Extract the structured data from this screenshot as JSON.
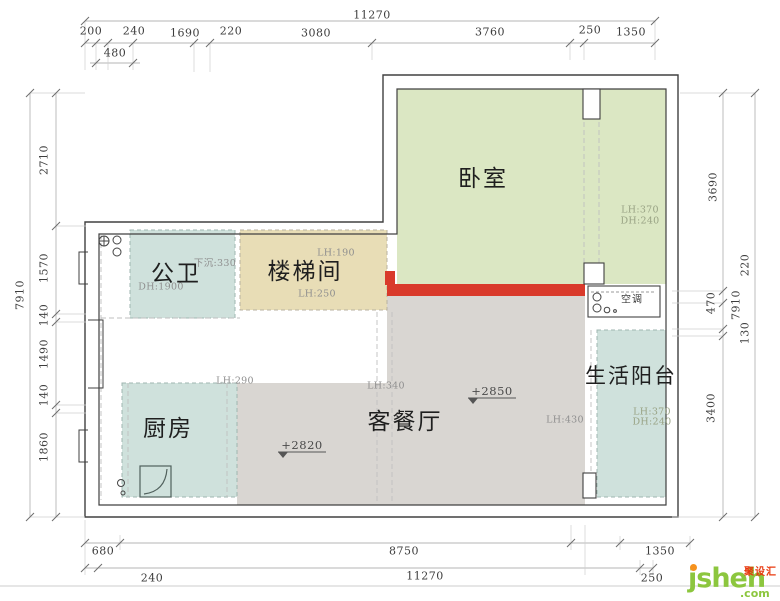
{
  "title": "apartment floor plan",
  "colors": {
    "bedroom_fill": "#dbe7c3",
    "stairwell_fill": "#e8ddb6",
    "teal_fill": "#cfe1dc",
    "living_fill": "#d9d6d2",
    "red_wall": "#d93a2b",
    "dimension_text": "#3d3d3d",
    "logo_green": "#8cc63e",
    "logo_orange": "#f6921e",
    "logo_red": "#e8380d"
  },
  "rooms": {
    "bedroom": {
      "label": "卧室",
      "lh": "LH:370",
      "dh": "DH:240"
    },
    "bathroom": {
      "label": "公卫",
      "sunken": "下沉:330",
      "dh": "DH:1900"
    },
    "stairwell": {
      "label": "楼梯间",
      "lh_top": "LH:190",
      "lh_bottom": "LH:250"
    },
    "kitchen": {
      "label": "厨房",
      "lh": "LH:290",
      "level": "+2820"
    },
    "living": {
      "label": "客餐厅",
      "lh_left": "LH:340",
      "lh_right": "LH:430",
      "level": "+2850"
    },
    "balcony": {
      "label": "生活阳台",
      "lh": "LH:370",
      "dh": "DH:240"
    },
    "ac": {
      "label": "空调"
    }
  },
  "dims": {
    "top_total": "11270",
    "top_row": [
      "200",
      "240",
      "1690",
      "220",
      "3080",
      "3760",
      "250",
      "1350"
    ],
    "top_sub": "480",
    "bottom_row": [
      "680",
      "8750",
      "1350"
    ],
    "bottom_total": [
      "240",
      "11270",
      "250"
    ],
    "left_total": "7910",
    "left_row": [
      "2710",
      "1570",
      "140",
      "1490",
      "140",
      "1860"
    ],
    "right_row": [
      "3690",
      "470",
      "3400"
    ],
    "right_outer": [
      "220",
      "7910",
      "130"
    ]
  },
  "logo": {
    "brand": "jsheh",
    "tld": ".com",
    "cn": "聚设汇"
  }
}
